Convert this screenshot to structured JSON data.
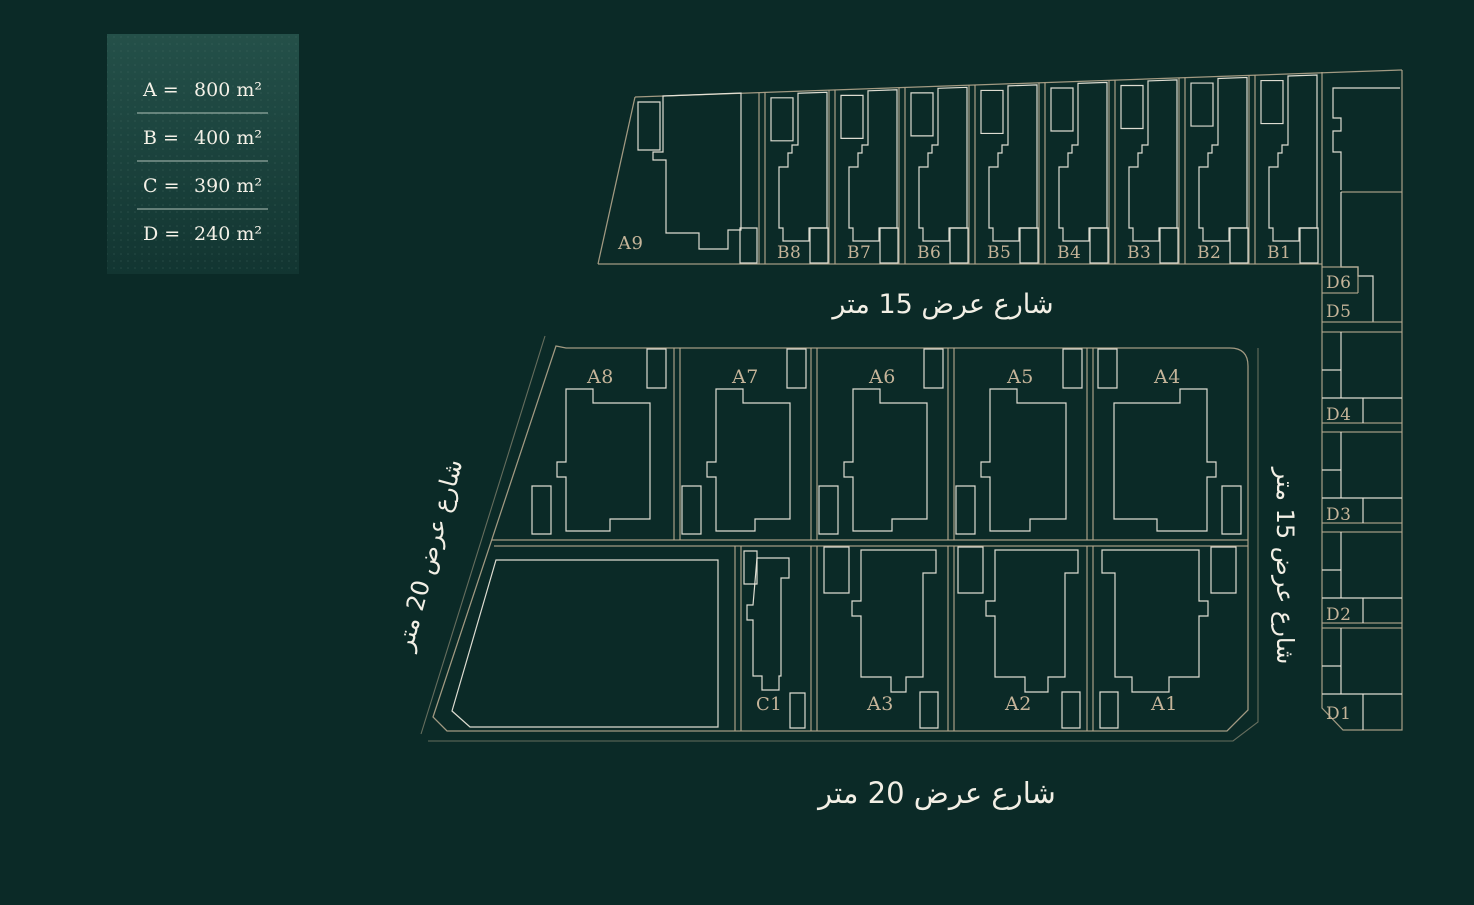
{
  "title": "Land plots site plan",
  "colors": {
    "background": "#0b2a27",
    "boundary_line": "#b3a68d",
    "building_line": "#e9e6da",
    "plot_label": "#c5b499",
    "street_label": "#f2efe5",
    "legend_gradient_top": "#245049",
    "legend_gradient_bottom": "#123531",
    "legend_divider": "#9fb3ab"
  },
  "legend": {
    "rows": [
      {
        "key": "A =",
        "value": "800 m²"
      },
      {
        "key": "B =",
        "value": "400 m²"
      },
      {
        "key": "C =",
        "value": "390 m²"
      },
      {
        "key": "D =",
        "value": "240 m²"
      }
    ]
  },
  "streets": {
    "top": "شارع عرض 15 متر",
    "bottom": "شارع عرض 20 متر",
    "left": "شارع عرض 20 متر",
    "right": "شارع عرض 15 متر"
  },
  "plots": {
    "top_row": [
      "A9",
      "B8",
      "B7",
      "B6",
      "B5",
      "B4",
      "B3",
      "B2",
      "B1"
    ],
    "middle_top": [
      "A8",
      "A7",
      "A6",
      "A5",
      "A4"
    ],
    "middle_bottom": [
      "C1",
      "A3",
      "A2",
      "A1"
    ],
    "right_column": [
      "D6",
      "D5",
      "D4",
      "D3",
      "D2",
      "D1"
    ]
  }
}
